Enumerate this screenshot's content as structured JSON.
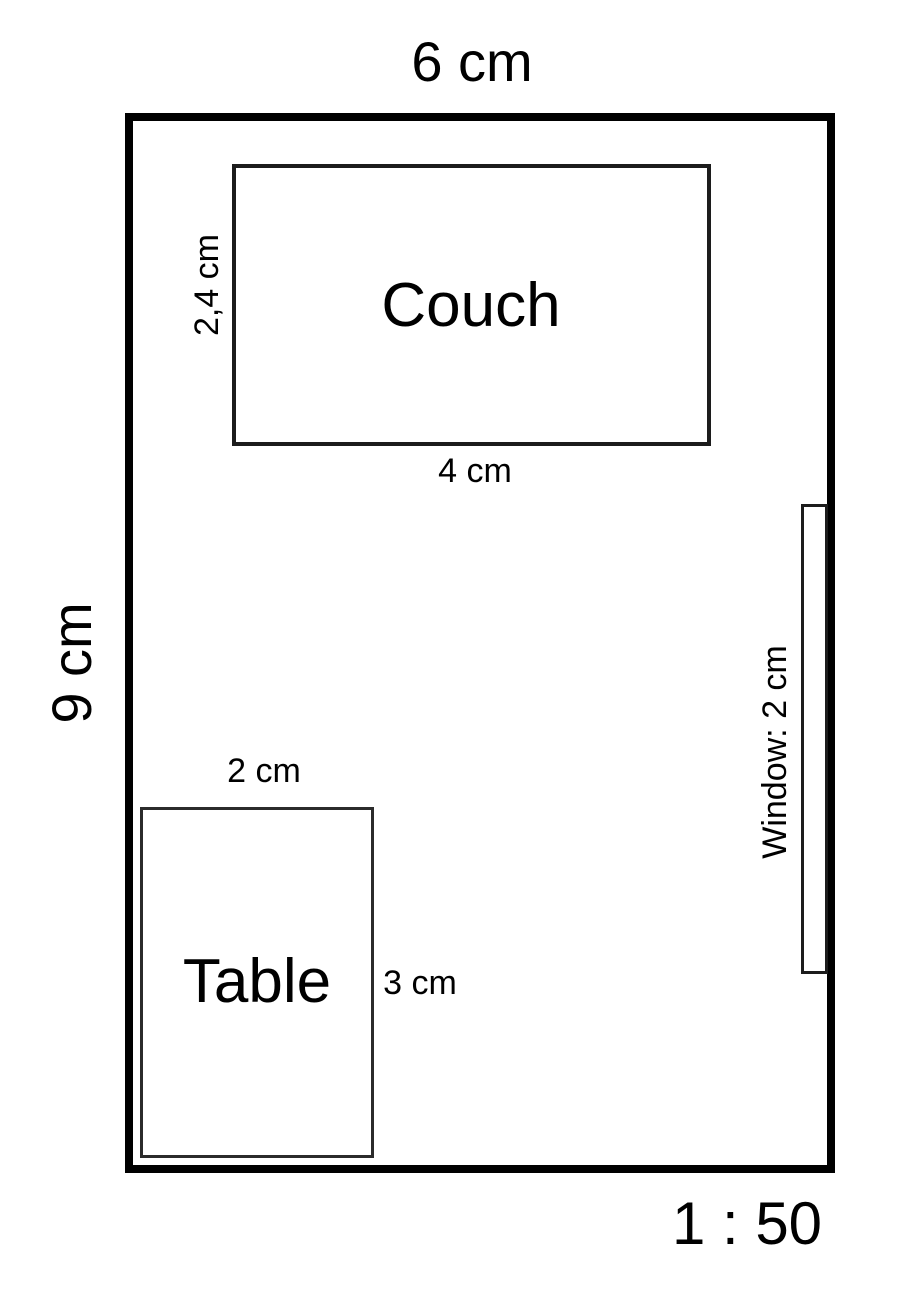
{
  "diagram": {
    "type": "floor-plan",
    "scale_label": "1 : 50"
  },
  "room": {
    "width_label": "6 cm",
    "height_label": "9 cm"
  },
  "couch": {
    "name": "Couch",
    "width_label": "4 cm",
    "height_label": "2,4 cm"
  },
  "table": {
    "name": "Table",
    "width_label": "2 cm",
    "height_label": "3 cm"
  },
  "window": {
    "label": "Window: 2 cm"
  },
  "colors": {
    "background": "#ffffff",
    "wall_line": "#000000",
    "furniture_line": "#1c1c1c",
    "text": "#000000"
  }
}
